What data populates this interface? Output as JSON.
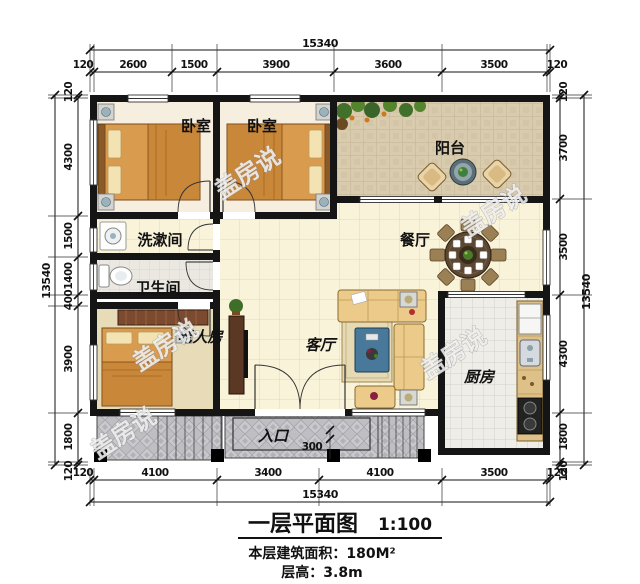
{
  "plan": {
    "rooms": {
      "bedroom_left": {
        "label": "卧室"
      },
      "bedroom_right": {
        "label": "卧室"
      },
      "balcony": {
        "label": "阳台"
      },
      "washroom": {
        "label": "洗漱间"
      },
      "bathroom": {
        "label": "卫生间"
      },
      "dining": {
        "label": "餐厅"
      },
      "elder_room": {
        "label": "老人房"
      },
      "living": {
        "label": "客厅"
      },
      "kitchen": {
        "label": "厨房"
      },
      "entrance": {
        "label": "入口"
      }
    },
    "dims": {
      "top": {
        "total": "15340",
        "segments": [
          "120",
          "2600",
          "1500",
          "3900",
          "3600",
          "3500",
          "120"
        ]
      },
      "bottom": {
        "total": "15340",
        "segments": [
          "120",
          "4100",
          "3400",
          "4100",
          "3500",
          "120"
        ]
      },
      "left": {
        "total": "13540",
        "segments": [
          "120",
          "4300",
          "1500",
          "1400",
          "400",
          "3900",
          "1800",
          "120"
        ]
      },
      "right": {
        "total": "13540",
        "segments": [
          "120",
          "3700",
          "3500",
          "4300",
          "1800",
          "120"
        ]
      },
      "porch_step": "300"
    }
  },
  "titleblock": {
    "title": "一层平面图",
    "scale": "1:100",
    "area": "本层建筑面积：180M²",
    "floor_height": "层高：3.8m"
  },
  "watermark": {
    "text": "盖房说"
  },
  "colors": {
    "wall": "#151515",
    "floor_cream": "#f9f3da",
    "floor_balcony": "#d9cbad",
    "floor_kitchen": "#eeede8",
    "porch_gray": "#bfbfc3",
    "bed_orange": "#d99b4d",
    "sofa_tan": "#ecca8a",
    "table_brown": "#5c4732",
    "coffee_table_blue": "#48789a"
  }
}
